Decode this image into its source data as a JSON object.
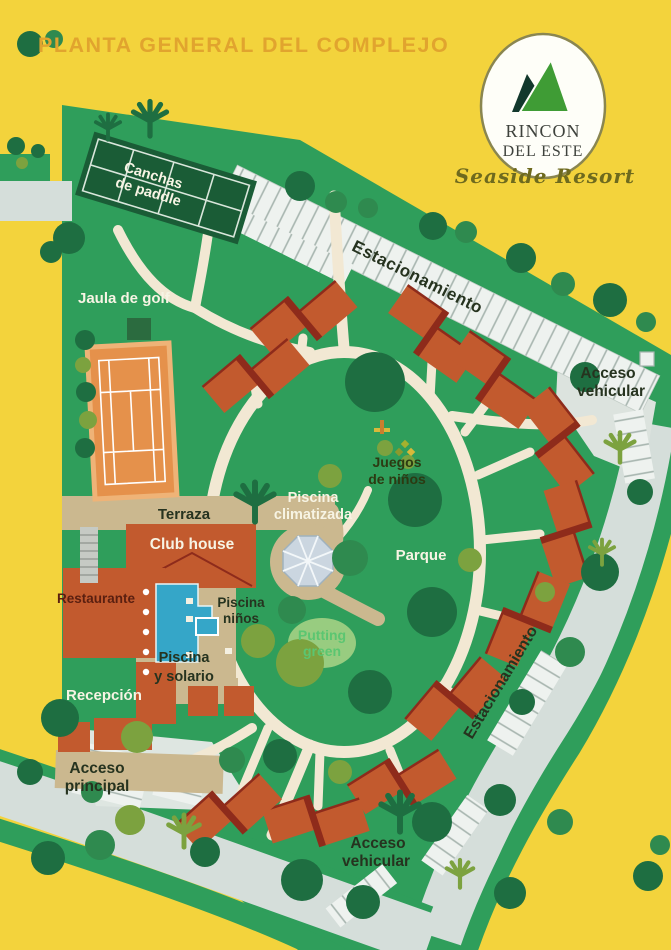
{
  "title": "PLANTA GENERAL DEL COMPLEJO",
  "logo": {
    "line1": "RINCON",
    "line2": "DEL ESTE",
    "tagline": "Seaside Resort"
  },
  "labels": {
    "canchas1": "Canchas",
    "canchas2": "de paddle",
    "jaula": "Jaula de golf",
    "estacionamiento_top": "Estacionamiento",
    "acceso_vehicular_top1": "Acceso",
    "acceso_vehicular_top2": "vehicular",
    "juegos1": "Juegos",
    "juegos2": "de niños",
    "piscina_clim1": "Piscina",
    "piscina_clim2": "climatizada",
    "terraza": "Terraza",
    "club_house": "Club house",
    "parque": "Parque",
    "restaurante": "Restaurante",
    "piscina_ninos1": "Piscina",
    "piscina_ninos2": "niños",
    "putting1": "Putting",
    "putting2": "green",
    "piscina_sol1": "Piscina",
    "piscina_sol2": "y solario",
    "recepcion": "Recepción",
    "acceso_principal1": "Acceso",
    "acceso_principal2": "principal",
    "estacionamiento_right": "Estacionamiento",
    "acceso_vehicular_bot1": "Acceso",
    "acceso_vehicular_bot2": "vehicular"
  },
  "colors": {
    "bg": "#F3D33C",
    "site-green": "#2F9E5B",
    "road": "#D5DEDA",
    "parking": "#EEF2EF",
    "hatch": "#A7B5AF",
    "path-cream": "#F2E8D3",
    "tan": "#CBB88F",
    "rust": "#C25A2E",
    "ridge": "#8E2B1B",
    "tennis": "#E5914B",
    "tennis-border": "#EFB377",
    "paddle": "#1A5C36",
    "pool": "#35A6C8",
    "octagon": "#CBD6E0",
    "title": "#E1A42E",
    "logo-green": "#3F9C35",
    "logo-dark": "#12382C",
    "label-dark": "#26331F",
    "label-white": "#F7F4E4",
    "putting-text": "#5BC671",
    "restaurant-label": "#5A1F10",
    "tree-dark": "#1E6E41",
    "tree-med": "#2F8A4F",
    "tree-olive": "#7CA23F"
  }
}
